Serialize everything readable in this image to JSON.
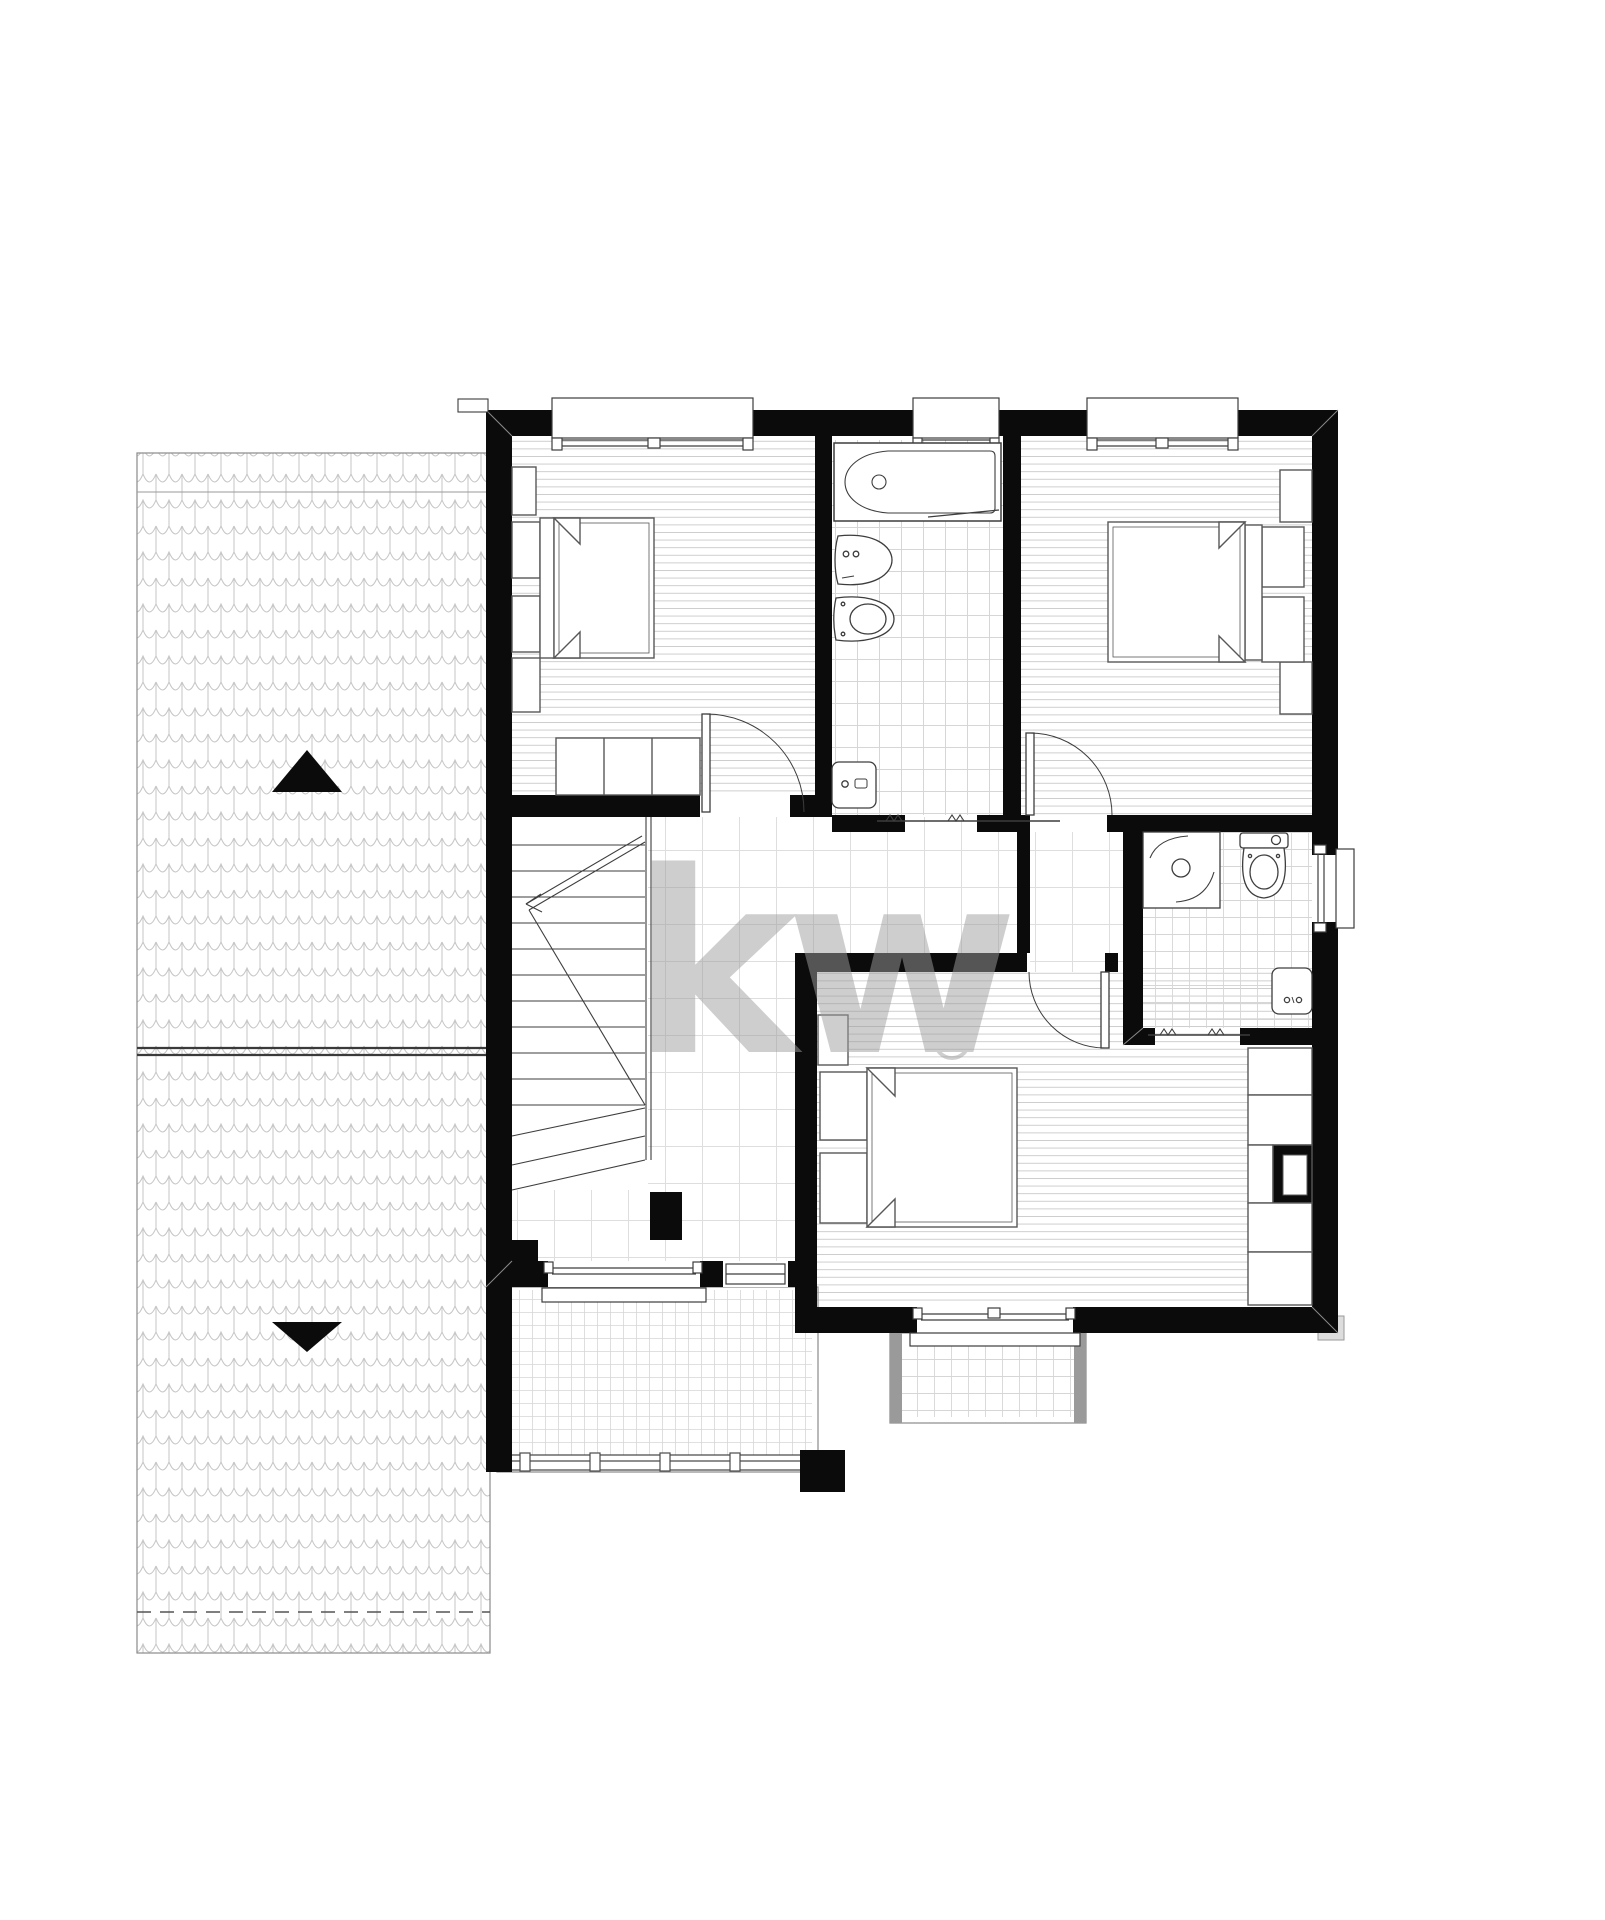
{
  "watermark": {
    "brand": "kw",
    "registered": "®",
    "color": "#b8b8b8"
  },
  "palette": {
    "background": "#ffffff",
    "wall": "#0b0b0b",
    "fixture_line": "#4a4a4a",
    "wood_floor_line": "#cccccc",
    "tile_line": "#d6d6d6",
    "hall_tile_line": "#dedede",
    "roof_tile_line": "#c6c6c6",
    "watermark_gray": "#b8b8b8"
  },
  "plan": {
    "floor_type": "upper-floor",
    "rooms": [
      {
        "name": "bedroom-top-left",
        "floor": "wood",
        "fixtures": [
          "double-bed",
          "nightstand",
          "nightstand",
          "wardrobe-3-door",
          "cabinet",
          "window",
          "door"
        ]
      },
      {
        "name": "bathroom-main",
        "floor": "tile",
        "fixtures": [
          "bathtub",
          "bidet",
          "toilet",
          "washbasin",
          "window",
          "sliding-door"
        ]
      },
      {
        "name": "bedroom-top-right",
        "floor": "wood",
        "fixtures": [
          "double-bed",
          "nightstand",
          "nightstand",
          "wall-cabinet",
          "wall-cabinet",
          "window",
          "door"
        ]
      },
      {
        "name": "hallway",
        "floor": "tile",
        "fixtures": [
          "staircase",
          "door-to-bedroom-bottom"
        ]
      },
      {
        "name": "bathroom-small",
        "floor": "tile",
        "fixtures": [
          "shower",
          "toilet",
          "washbasin",
          "window",
          "sliding-door"
        ]
      },
      {
        "name": "bedroom-bottom",
        "floor": "wood",
        "fixtures": [
          "double-bed",
          "nightstand",
          "nightstand",
          "closet-run",
          "duct-shaft",
          "window"
        ]
      },
      {
        "name": "balcony-large",
        "floor": "tile",
        "fixtures": [
          "railing",
          "balcony-door",
          "window-sill"
        ]
      },
      {
        "name": "balcony-small",
        "floor": "tile",
        "fixtures": [
          "window-sill"
        ]
      }
    ],
    "roof": {
      "position": "left-strip",
      "arrows": [
        {
          "glyph": "up-triangle"
        },
        {
          "glyph": "down-triangle"
        }
      ],
      "ridge_line": "horizontal-double-line",
      "eave_line": "dashed"
    }
  }
}
